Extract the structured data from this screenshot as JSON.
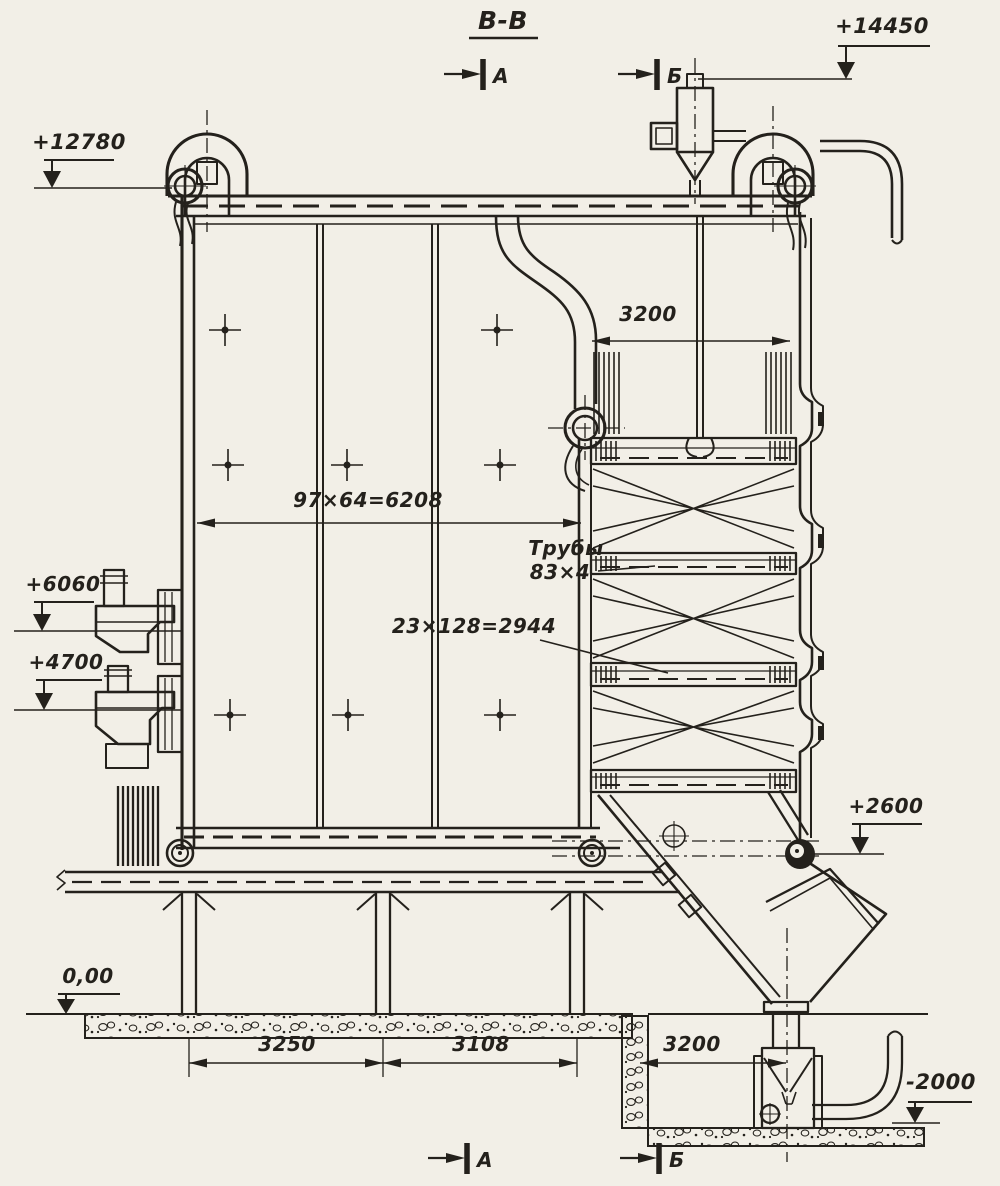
{
  "drawing": {
    "title": "В-В",
    "sections": {
      "a": "А",
      "b": "Б"
    },
    "elevations": {
      "e14450": "+14450",
      "e12780": "+12780",
      "e6060": "+6060",
      "e4700": "+4700",
      "e2600": "+2600",
      "e000": "0,00",
      "em2000": "-2000"
    },
    "dimensions": {
      "shaft_width": "3200",
      "furnace_width": "97×64=6208",
      "bank_width": "23×128=2944",
      "span1": "3250",
      "span2": "3108",
      "span3": "3200"
    },
    "labels": {
      "tubes1": "Трубы",
      "tubes2": "83×4"
    },
    "colors": {
      "paper": "#f2efe7",
      "ink": "#24211c"
    }
  }
}
